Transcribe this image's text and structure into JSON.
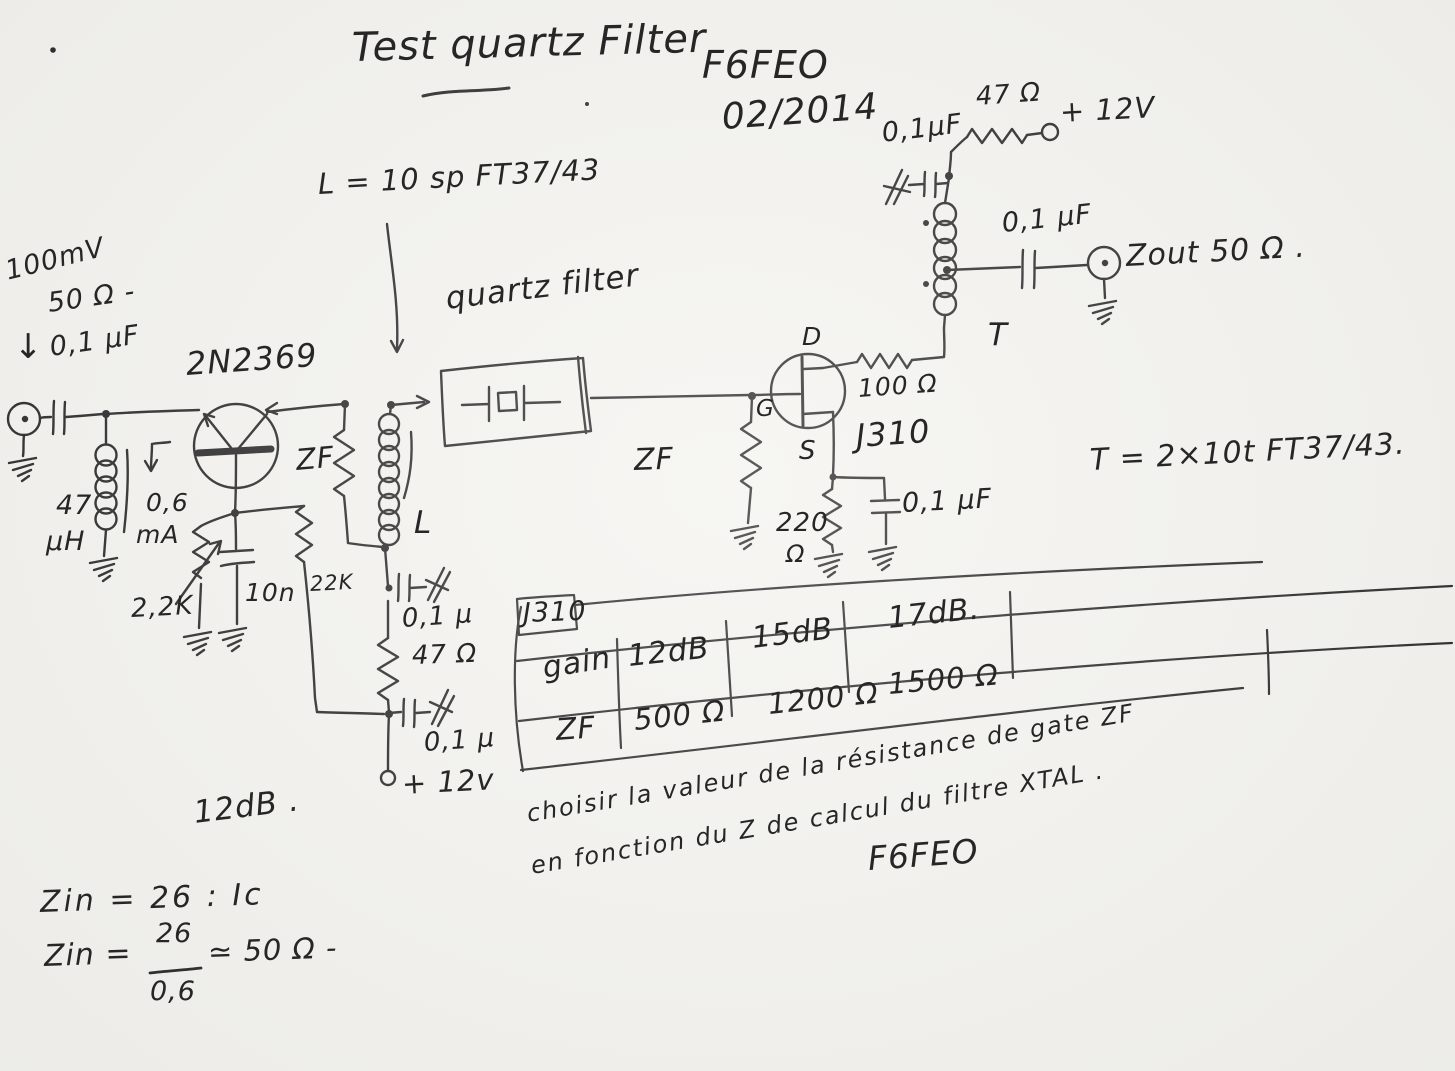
{
  "document": {
    "title": "Test quartz Filter",
    "callsign": "F6FEO",
    "date": "02/2014",
    "signature": "F6FEO"
  },
  "schematic": {
    "input": {
      "level": "100mV",
      "impedance": "50 Ω -",
      "cap": "0,1 µF",
      "choke": "47",
      "choke_unit": "µH",
      "current": "0,6",
      "current_unit": "mA"
    },
    "q1": {
      "part": "2N2369",
      "emitter_pot": "2,2K",
      "base_cap": "10n",
      "base_resistor": "22K",
      "stage_gain": "12dB ."
    },
    "tank": {
      "coil_note": "L = 10 sp FT37/43",
      "zf": "ZF",
      "coil": "L",
      "cap1": "0,1 µ",
      "res": "47 Ω",
      "cap2": "0,1 µ",
      "supply": "+ 12v"
    },
    "filter": {
      "caption": "quartz filter"
    },
    "q2": {
      "part": "J310",
      "drain_label": "D",
      "gate_label": "G",
      "source_label": "S",
      "gate_res": "ZF",
      "drain_res": "100 Ω",
      "source_res": "220",
      "source_res_unit": "Ω",
      "source_cap": "0,1 µF"
    },
    "output": {
      "transformer": "T",
      "note": "T = 2×10t   FT37/43.",
      "top_cap": "0,1µF",
      "top_res": "47 Ω",
      "supply": "+ 12V",
      "out_cap": "0,1 µF",
      "zout": "Zout 50 Ω ."
    }
  },
  "table": {
    "corner": "J310",
    "rows": [
      {
        "label": "gain",
        "values": [
          "12dB",
          "15dB",
          "17dB."
        ]
      },
      {
        "label": "ZF",
        "values": [
          "500 Ω",
          "1200 Ω",
          "1500 Ω"
        ]
      }
    ]
  },
  "notes": {
    "line1": "choisir la valeur de la résistance de gate ZF",
    "line2": "en fonction du Z de calcul du filtre XTAL .",
    "zin1": "Zin = 26 : Ic",
    "zin2_lhs": "Zin =",
    "zin2_num": "26",
    "zin2_den": "0,6",
    "zin2_rhs": "≃ 50 Ω -"
  }
}
